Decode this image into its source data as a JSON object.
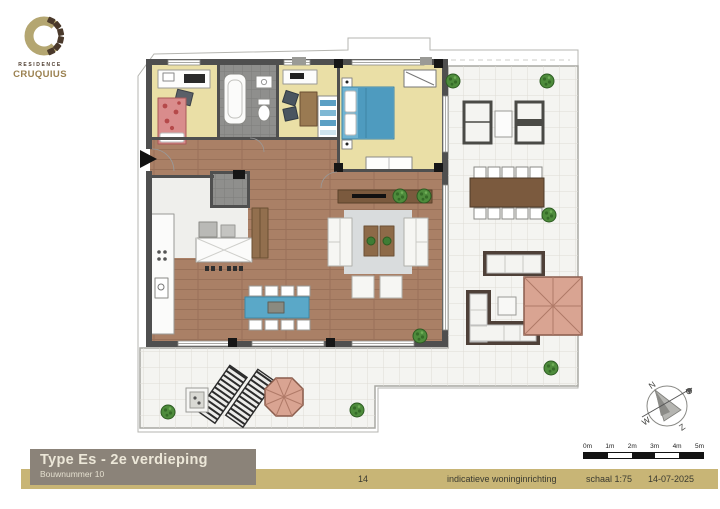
{
  "logo": {
    "residence": "RESIDENCE",
    "brand": "CRUQUIUS"
  },
  "title_block": {
    "title": "Type Es - 2e verdieping",
    "subtitle": "Bouwnummer 10"
  },
  "footer": {
    "page": "14",
    "note": "indicatieve woninginrichting",
    "scale": "schaal 1:75",
    "date": "14-07-2025"
  },
  "scale_bar": {
    "labels": [
      "0m",
      "1m",
      "2m",
      "3m",
      "4m",
      "5m"
    ]
  },
  "compass": {
    "north": "N",
    "east": "O",
    "south": "Z",
    "west": "W"
  },
  "colors": {
    "footer_band": "#c8b576",
    "title_bg": "#8b8379",
    "logo_tan": "#b4a671",
    "logo_brown": "#4a392b",
    "wood_floor": "#aa8066",
    "room_yellow": "#eadfa6",
    "terrace_tile": "#f4f4f1",
    "bathroom_tile": "#8f8f8d",
    "wall": "#4f4f4f",
    "accent_blue": "#5aa8c8",
    "parasol_pink": "#d9a492",
    "plant_green": "#4e8c3c"
  }
}
